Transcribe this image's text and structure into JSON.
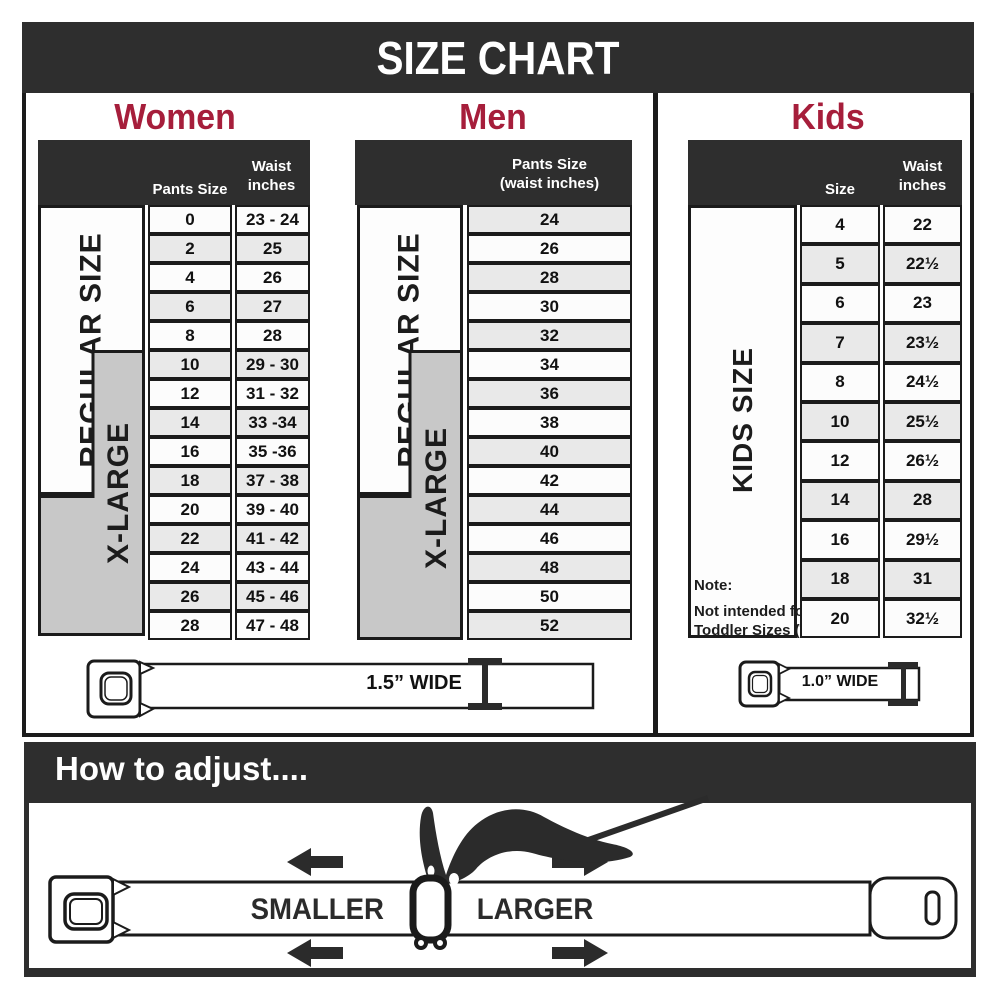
{
  "title": "SIZE CHART",
  "colors": {
    "accent_red": "#A61E3B",
    "panel_dark": "#2E2E2E",
    "row_alt_gray": "#E9E9E9",
    "xlarge_gray": "#C8C8C8",
    "ink": "#1B1B1B"
  },
  "women": {
    "heading": "Women",
    "columns": {
      "pants_size": "Pants Size",
      "waist_line1": "Waist",
      "waist_line2": "inches"
    },
    "regular_label": "REGULAR SIZE",
    "xlarge_label": "X-LARGE",
    "rows": [
      {
        "size": "0",
        "waist": "23 - 24"
      },
      {
        "size": "2",
        "waist": "25"
      },
      {
        "size": "4",
        "waist": "26"
      },
      {
        "size": "6",
        "waist": "27"
      },
      {
        "size": "8",
        "waist": "28"
      },
      {
        "size": "10",
        "waist": "29 - 30"
      },
      {
        "size": "12",
        "waist": "31 - 32"
      },
      {
        "size": "14",
        "waist": "33 -34"
      },
      {
        "size": "16",
        "waist": "35 -36"
      },
      {
        "size": "18",
        "waist": "37 - 38"
      },
      {
        "size": "20",
        "waist": "39 - 40"
      },
      {
        "size": "22",
        "waist": "41 - 42"
      },
      {
        "size": "24",
        "waist": "43 - 44"
      },
      {
        "size": "26",
        "waist": "45 - 46"
      },
      {
        "size": "28",
        "waist": "47 - 48"
      }
    ],
    "belt_label": "1.5” WIDE"
  },
  "men": {
    "heading": "Men",
    "columns": {
      "header_line1": "Pants Size",
      "header_line2": "(waist inches)"
    },
    "regular_label": "REGULAR SIZE",
    "xlarge_label": "X-LARGE",
    "rows": [
      "24",
      "26",
      "28",
      "30",
      "32",
      "34",
      "36",
      "38",
      "40",
      "42",
      "44",
      "46",
      "48",
      "50",
      "52"
    ]
  },
  "kids": {
    "heading": "Kids",
    "columns": {
      "size": "Size",
      "waist_line1": "Waist",
      "waist_line2": "inches"
    },
    "side_label": "KIDS SIZE",
    "note": {
      "line1": "Note:",
      "line2": "Not intended for",
      "line3": "Toddler Sizes (T)"
    },
    "rows": [
      {
        "size": "4",
        "waist": "22"
      },
      {
        "size": "5",
        "waist": "22½"
      },
      {
        "size": "6",
        "waist": "23"
      },
      {
        "size": "7",
        "waist": "23½"
      },
      {
        "size": "8",
        "waist": "24½"
      },
      {
        "size": "10",
        "waist": "25½"
      },
      {
        "size": "12",
        "waist": "26½"
      },
      {
        "size": "14",
        "waist": "28"
      },
      {
        "size": "16",
        "waist": "29½"
      },
      {
        "size": "18",
        "waist": "31"
      },
      {
        "size": "20",
        "waist": "32½"
      }
    ],
    "belt_label": "1.0” WIDE"
  },
  "adjust": {
    "heading": "How to adjust....",
    "smaller_label": "SMALLER",
    "larger_label": "LARGER"
  }
}
